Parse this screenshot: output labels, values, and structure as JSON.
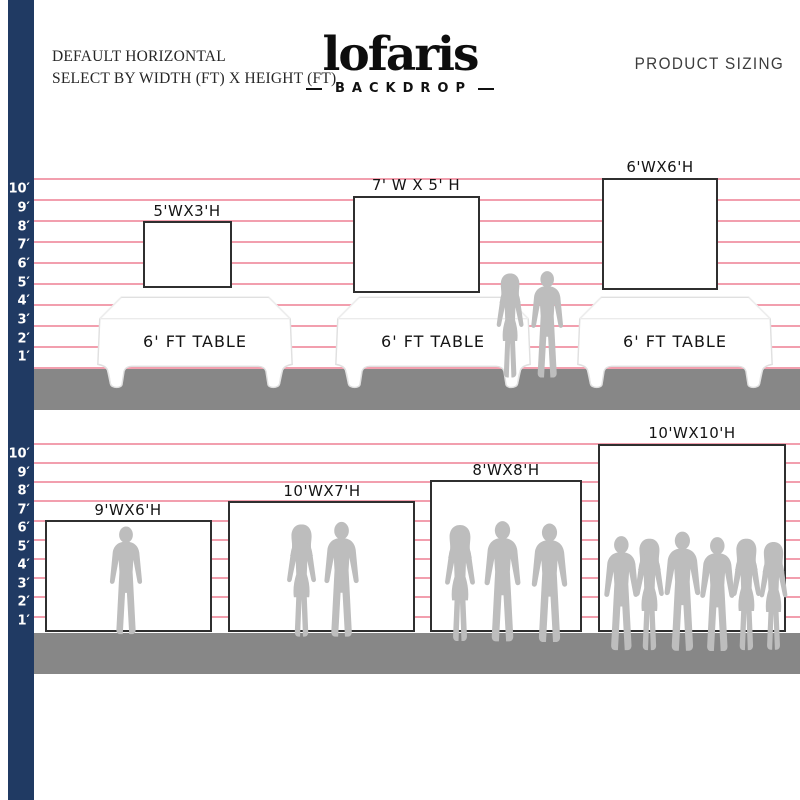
{
  "header": {
    "note_line1": "DEFAULT HORIZONTAL",
    "note_line2": "SELECT BY WIDTH (FT) X HEIGHT (FT)",
    "logo": {
      "wordmark": "lofaris",
      "tagline": "BACKDROP"
    },
    "right_title": "PRODUCT SIZING"
  },
  "rulers": {
    "top_labels": [
      "10′",
      "9′",
      "8′",
      "7′",
      "6′",
      "5′",
      "4′",
      "3′",
      "2′",
      "1′"
    ],
    "bottom_labels": [
      "10′",
      "9′",
      "8′",
      "7′",
      "6′",
      "5′",
      "4′",
      "3′",
      "2′",
      "1′"
    ]
  },
  "top_section": {
    "backdrops": [
      {
        "label": "5'WX3'H"
      },
      {
        "label": "7' W X 5' H"
      },
      {
        "label": "6'WX6'H"
      }
    ],
    "tables": [
      {
        "label": "6' FT TABLE"
      },
      {
        "label": "6' FT TABLE"
      },
      {
        "label": "6' FT TABLE"
      }
    ],
    "silhouettes": [
      "couple-silhouette"
    ]
  },
  "bottom_section": {
    "backdrops": [
      {
        "label": "9'WX6'H"
      },
      {
        "label": "10'WX7'H"
      },
      {
        "label": "8'WX8'H"
      },
      {
        "label": "10'WX10'H"
      }
    ],
    "silhouettes": [
      "single-man-silhouette",
      "couple-silhouette",
      "group-of-three-silhouette",
      "group-of-six-silhouette"
    ]
  },
  "colors": {
    "ruler_bar_navy": "#203a63",
    "gridline_pink": "#f29fae",
    "floor_gray": "#878787",
    "silhouette_gray": "#bdbdbd",
    "backdrop_border": "#2f2f2f"
  }
}
